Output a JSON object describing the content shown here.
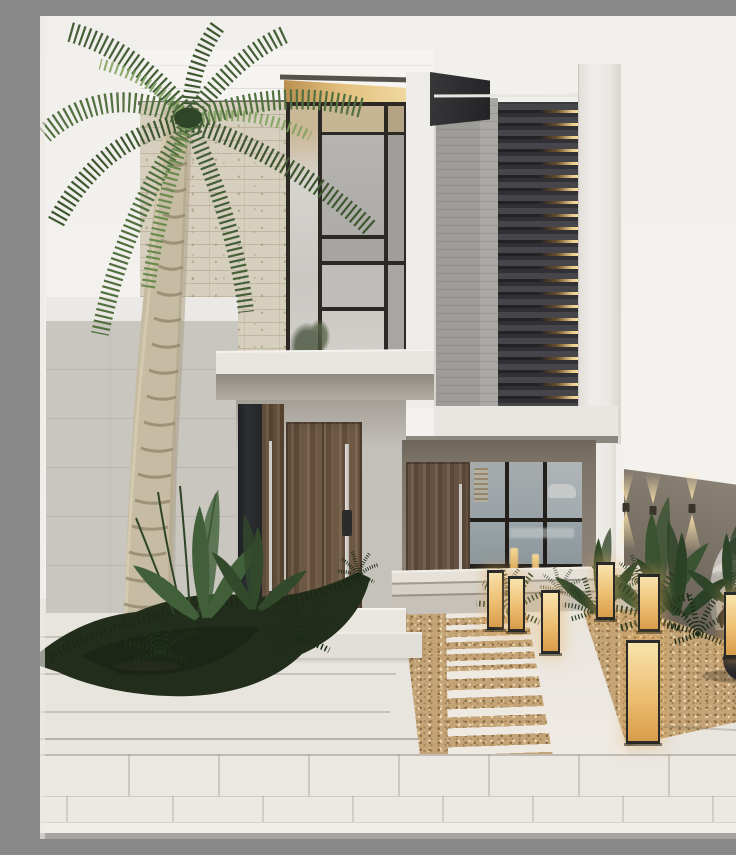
{
  "meta": {
    "title": "Modern minimalist villa exterior",
    "description": "Photorealistic render of a two-storey modern villa: stone and textured-concrete facades, a backlit dark louver screen, wooden entry doors with long steel pulls, a tall palm tree, dark ground-cover landscaping, a gravel walkway with stone slats, glowing box lanterns, a taupe boundary wall with up/down sconce lights and a partially visible silver SUV.",
    "domain": "Natural-Image",
    "visible_text": []
  },
  "palette": {
    "sky": "#f2f0ec",
    "parapet_white": "#f6f4f1",
    "stone_wall": "#d7cfbe",
    "gray_concrete": "#9e9c98",
    "louver_dark": "#3a3a3e",
    "louver_glow": "#f0d394",
    "soffit_glow": "#e2bf7e",
    "wood_door": "#6e5945",
    "taupe_wall": "#857b6f",
    "boundary_wall": "#7b7266",
    "pavement": "#e8e4de",
    "gravel": "#c4a476",
    "plant_dark": "#24321e",
    "plant_light": "#6b8b4e",
    "palm_trunk": "#c6bca3",
    "lantern_glow": "#edbf72",
    "car_body": "#b4b1ac",
    "window_mullion": "#2c2925"
  },
  "objects": {
    "palm_tree": {
      "label": "tall palm tree, left side",
      "fronds": 10
    },
    "lanterns": {
      "count": 7,
      "style": "rectangular black-frame box lights, warm glow"
    },
    "wall_sconces": {
      "count": 4,
      "style": "up/down light cones on boundary wall"
    },
    "doors": {
      "count": 3,
      "material": "walnut wood, vertical grain, steel pull handles"
    },
    "windows": {
      "upper_curtain_wall": "black mullion grid, 2 storeys",
      "ground_glass_door": "3x3 black grid with water and plant reflections"
    },
    "car": {
      "label": "silver SUV, partial front view, right edge"
    },
    "path": {
      "label": "gravel strip path with white stone slats and solid walkway, flanked by planted gravel beds"
    }
  }
}
